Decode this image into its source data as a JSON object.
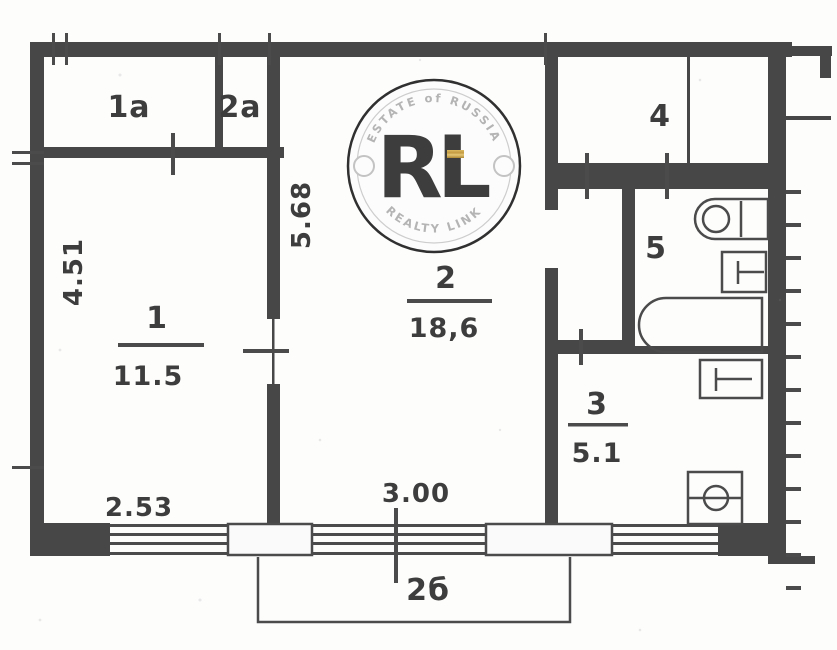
{
  "document": {
    "type": "apartment-floor-plan-scan",
    "colors": {
      "ink": "#3c3c3c",
      "paper": "#fdfdfc",
      "gold": "#c79f4a"
    }
  },
  "rooms": {
    "closet1": {
      "number": "1а"
    },
    "closet2": {
      "number": "2а"
    },
    "room1": {
      "number": "1",
      "area": "11.5"
    },
    "room2": {
      "number": "2",
      "area": "18,6"
    },
    "room3": {
      "number": "3",
      "area": "5.1"
    },
    "room4": {
      "number": "4"
    },
    "room5": {
      "number": "5"
    },
    "balcony": {
      "number": "2б"
    }
  },
  "dimensions": {
    "room1_height": "4.51",
    "room1_width": "2.53",
    "room2_height": "5.68",
    "room2_width": "3.00"
  },
  "fixtures": [
    "toilet",
    "wash-basin",
    "bathtub",
    "kitchen-sink",
    "stove"
  ],
  "watermark": {
    "arc_top": "ESTATE of RUSSIA",
    "monogram": "RL",
    "arc_bottom": "REALTY LINK",
    "gold": "#c79f4a"
  }
}
